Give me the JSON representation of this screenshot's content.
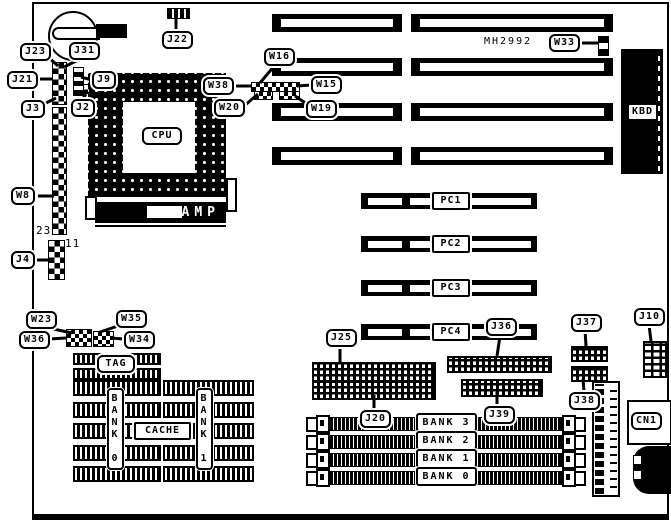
{
  "diagram_type": "motherboard-layout",
  "part_number": "MH2992",
  "labels": {
    "j23": "J23",
    "j31": "J31",
    "j21": "J21",
    "j3": "J3",
    "j9": "J9",
    "j2": "J2",
    "j22": "J22",
    "w8": "W8",
    "j4": "J4",
    "w23": "W23",
    "w35": "W35",
    "w36": "W36",
    "w34": "W34",
    "w16": "W16",
    "w38": "W38",
    "w20": "W20",
    "w15": "W15",
    "w19": "W19",
    "w33": "W33",
    "j25": "J25",
    "j36": "J36",
    "j37": "J37",
    "j10": "J10",
    "j20": "J20",
    "j39": "J39",
    "j38": "J38"
  },
  "components": {
    "cpu": "CPU",
    "amp": "AMP",
    "kbd": "KBD",
    "cn1": "CN1",
    "tag": "TAG",
    "cache": "CACHE",
    "w8_pin_number": "23",
    "j4_pin_number": "11",
    "cache_bank_left": "BANK 0",
    "cache_bank_right": "BANK 1"
  },
  "pci_slots": [
    "PC1",
    "PC2",
    "PC3",
    "PC4"
  ],
  "memory_banks": [
    "BANK 3",
    "BANK 2",
    "BANK 1",
    "BANK 0"
  ],
  "colors": {
    "ink": "#000000",
    "paper": "#ffffff"
  }
}
